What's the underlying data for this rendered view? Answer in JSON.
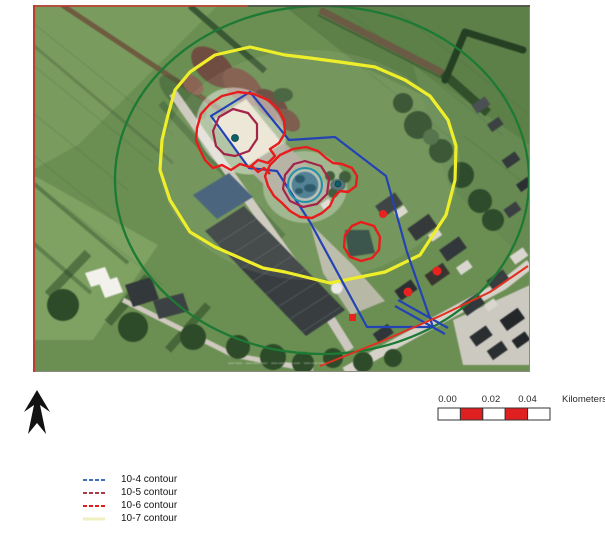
{
  "figure": {
    "type": "aerial-photo risk contour map",
    "watermark_text": "—— ——— ———— ———"
  },
  "legend": {
    "items": [
      {
        "label": "10-4 contour",
        "color": "#3f6ec0",
        "style": "dashed"
      },
      {
        "label": "10-5 contour",
        "color": "#a93a4a",
        "style": "dashed"
      },
      {
        "label": "10-6 contour",
        "color": "#e21d1d",
        "style": "dashed"
      },
      {
        "label": "10-7 contour",
        "color": "#efefc0",
        "style": "solid"
      }
    ]
  },
  "scale_bar": {
    "tick_labels": [
      "0.00",
      "0.02",
      "0.04"
    ],
    "unit_label": "Kilometers",
    "segment_colors": [
      "#ffffff",
      "#e02020",
      "#ffffff",
      "#e02020",
      "#ffffff"
    ],
    "outline_color": "#333333"
  },
  "map_overlays": {
    "contour_colors": {
      "c10_4": "#2343b5",
      "c10_5": "#a42348",
      "c10_6": "#e81c1c",
      "c10_7": "#efee2b"
    },
    "other_colors": {
      "green_circle": "#1c7a34",
      "teal_circle": "#1f93a8",
      "risk_source_dot": "#0d6066",
      "vulnerable_object_dot": "#e8231f",
      "road_line": "#e03020",
      "scan_border": "#c23b2e"
    },
    "marker_counts": {
      "red_dots": 3,
      "red_square": 1,
      "teal_dots": 2
    }
  }
}
